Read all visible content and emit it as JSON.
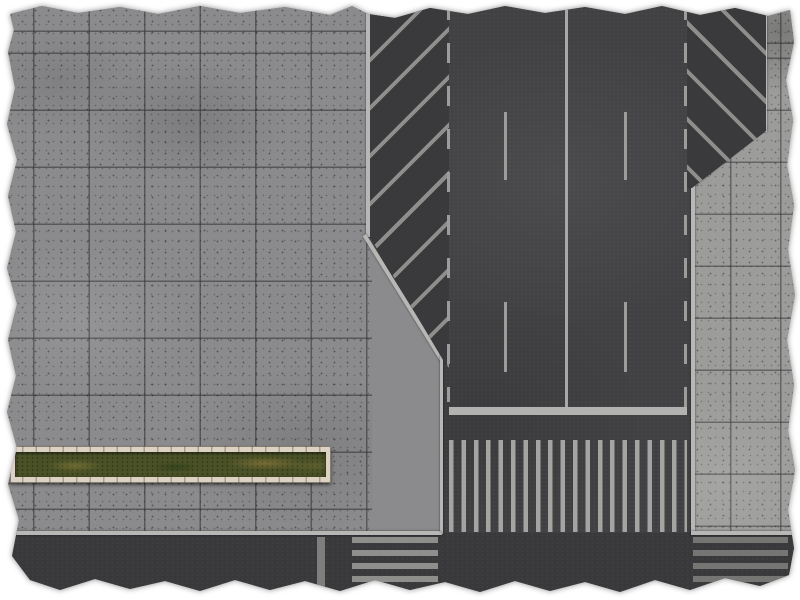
{
  "meta": {
    "title": "Top-down city street intersection gaming mat",
    "visible_text": "none",
    "edge_style": "torn paper edges on white background"
  },
  "colors": {
    "pavement": "#8b8b8d",
    "pavement_right": "#9c9c9a",
    "road": "#414143",
    "road_cross": "#39393b",
    "hatch_bg": "#3a3a3c",
    "hatch_stripe": "#8e8e8c",
    "marking": "#9c9c9a",
    "marking_bright": "#a8a8a6",
    "stop_line": "#b2b2b0",
    "crosswalk": "#a4a4a2",
    "crosswalk_west": "#8e8e8c",
    "crosswalk_east": "#757573",
    "curb": "#b7b7b5",
    "planter_stone": "#dcd2c3",
    "grass": "#4b5126",
    "background": "#ffffff"
  },
  "scene": {
    "mat": {
      "label": "city streets battle mat, aerial view, torn edges"
    },
    "sidewalk_left": {
      "label": "large concrete tile sidewalk plaza",
      "tile_grid_px": "≈55×57"
    },
    "sidewalk_right": {
      "label": "concrete tile sidewalk right of road",
      "tile_grid_px": "≈50×52"
    },
    "road_vertical": {
      "label": "asphalt avenue running top to bottom",
      "lanes": 4,
      "center_line": "solid",
      "lane_dividers": "long dashes",
      "edge_lines": "short dashed boundary lines"
    },
    "hatch_left": {
      "label": "diagonal hatched taper zone (left)",
      "stripe_direction": "/",
      "stripe_count": 8
    },
    "hatch_right": {
      "label": "diagonal hatched taper zone (right)",
      "stripe_direction": "\\",
      "stripe_count": 5
    },
    "stop_line_main": {
      "label": "stop line across avenue above crosswalk"
    },
    "crosswalk_main": {
      "label": "zebra crosswalk across avenue",
      "stripe_count": 19,
      "stripe_orientation": "vertical"
    },
    "road_horizontal": {
      "label": "asphalt cross street along bottom edge"
    },
    "crosswalk_west": {
      "label": "zebra crosswalk on cross street, west side",
      "stripe_count": 4,
      "stripe_orientation": "horizontal"
    },
    "crosswalk_east": {
      "label": "zebra crosswalk on cross street, east side",
      "stripe_count": 5,
      "stripe_orientation": "horizontal"
    },
    "stop_line_west": {
      "label": "stop line on cross street"
    },
    "planter": {
      "label": "long rectangular planter with stone border and grass"
    }
  }
}
